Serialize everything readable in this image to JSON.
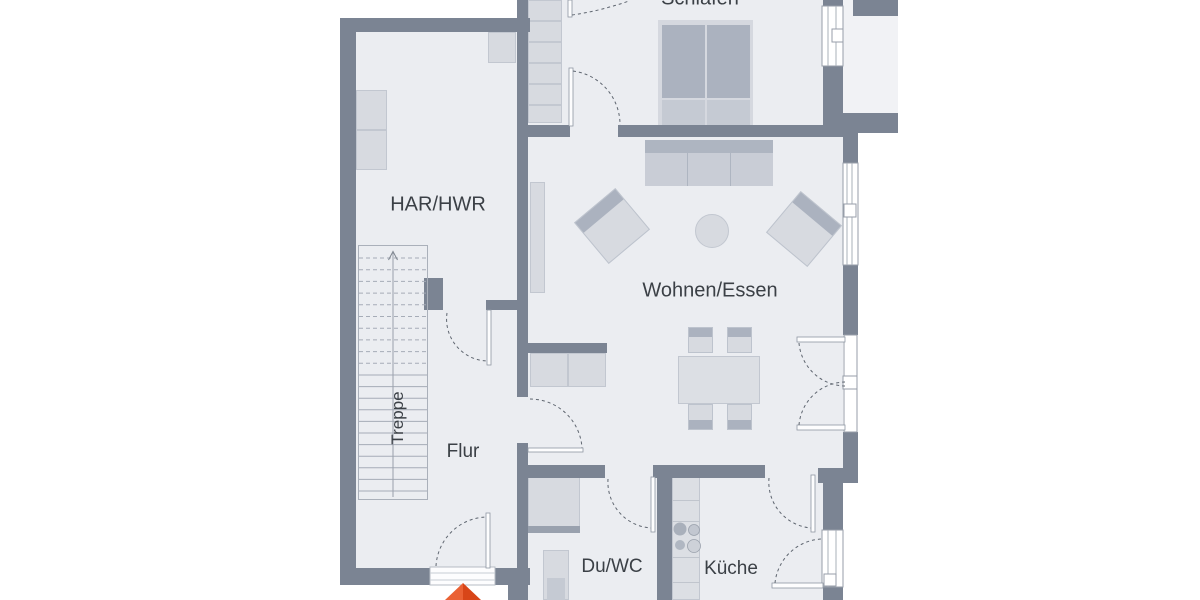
{
  "plan": {
    "type": "floor-plan",
    "language": "de"
  },
  "rooms": [
    {
      "id": "schlafen",
      "label": "Schlafen"
    },
    {
      "id": "har-hwr",
      "label": "HAR/HWR"
    },
    {
      "id": "wohnen-essen",
      "label": "Wohnen/Essen"
    },
    {
      "id": "treppe",
      "label": "Treppe"
    },
    {
      "id": "flur",
      "label": "Flur"
    },
    {
      "id": "du-wc",
      "label": "Du/WC"
    },
    {
      "id": "kueche",
      "label": "Küche"
    }
  ],
  "colors": {
    "wall": "#7b8493",
    "floor": "#ebedf1",
    "floor_light": "#f1f2f5",
    "furn": "#d7dae0",
    "furn_mid": "#c5cad3",
    "furn_dark": "#abb2bf",
    "line": "#9aa0ab",
    "frame": "#949ca8",
    "door_arc": "#5f6670",
    "accent": "#e2491c",
    "text": "#3b4046"
  },
  "markers": {
    "entrance_arrow": "entrance-direction-arrow",
    "stair_direction": "up"
  }
}
